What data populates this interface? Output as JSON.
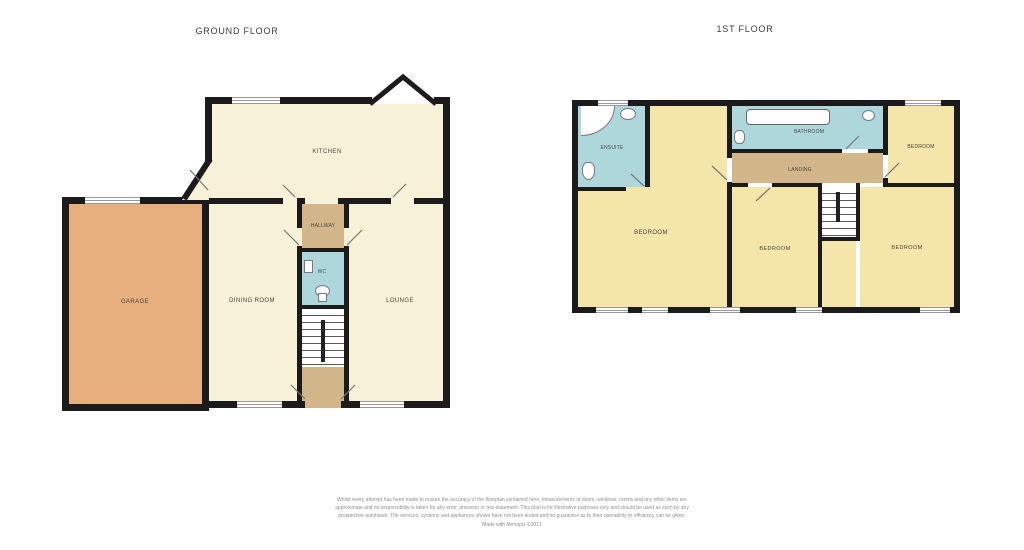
{
  "ground": {
    "title": "GROUND FLOOR",
    "rooms": {
      "kitchen": "KITCHEN",
      "dining": "DINING ROOM",
      "lounge": "LOUNGE",
      "garage": "GARAGE",
      "hallway": "HALLWAY",
      "wc": "WC"
    }
  },
  "first": {
    "title": "1ST FLOOR",
    "rooms": {
      "ensuite": "ENSUITE",
      "bathroom": "BATHROOM",
      "bedroom_left": "BEDROOM",
      "bedroom_top_right": "BEDROOM",
      "bedroom_mid": "BEDROOM",
      "bedroom_right": "BEDROOM",
      "landing": "LANDING"
    }
  },
  "colors": {
    "ground_room_cream": "#f7f2d7",
    "first_room_yellow": "#f4e5a9",
    "garage_orange": "#e7ae7e",
    "wet_room_blue": "#aed7dc",
    "hall_tan": "#d3b58a",
    "wall_black": "#1b1b1b"
  },
  "footer": {
    "disclaimer": "Whilst every attempt has been made to ensure the accuracy of the floorplan contained here, measurements of doors, windows, rooms and any other items are approximate and no responsibility is taken for any error, omission or mis-statement. This plan is for illustrative purposes only and should be used as such by any prospective purchaser. The services, systems and appliances shown have not been tested and no guarantee as to their operability or efficiency can be given.",
    "credit": "Made with Metropix ©2021"
  }
}
